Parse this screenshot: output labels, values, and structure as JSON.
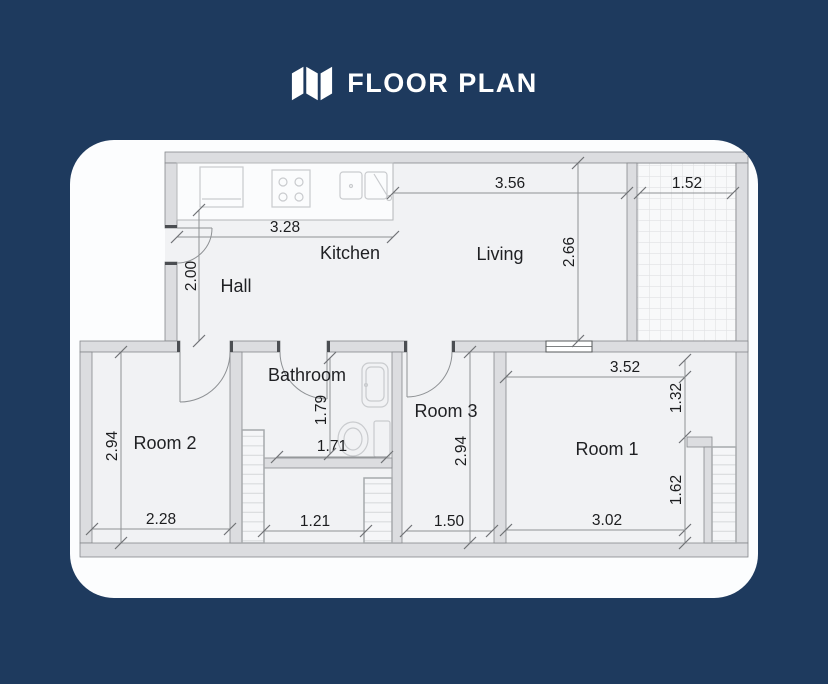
{
  "header": {
    "title": "FLOOR PLAN"
  },
  "colors": {
    "background": "#1e3a5e",
    "card": "#fcfdfe",
    "floor": "#f1f2f4",
    "wall_fill": "#dcdde0",
    "dim_line": "#8f9295",
    "text": "#1c1d1f"
  },
  "rooms": {
    "kitchen": "Kitchen",
    "living": "Living",
    "hall": "Hall",
    "bathroom": "Bathroom",
    "room1": "Room 1",
    "room2": "Room 2",
    "room3": "Room 3"
  },
  "dimensions": {
    "kitchen_width": "3.28",
    "living_width": "3.56",
    "balcony_width": "1.52",
    "hall_height": "2.00",
    "living_height": "2.66",
    "room2_height": "2.94",
    "room2_width": "2.28",
    "bathroom_height": "1.79",
    "bathroom_width": "1.71",
    "lower_hall_width": "1.21",
    "room3_height": "2.94",
    "room3_width": "1.50",
    "room1_top_width": "3.52",
    "room1_right_upper_height": "1.32",
    "room1_right_lower_height": "1.62",
    "room1_bottom_width": "3.02"
  }
}
